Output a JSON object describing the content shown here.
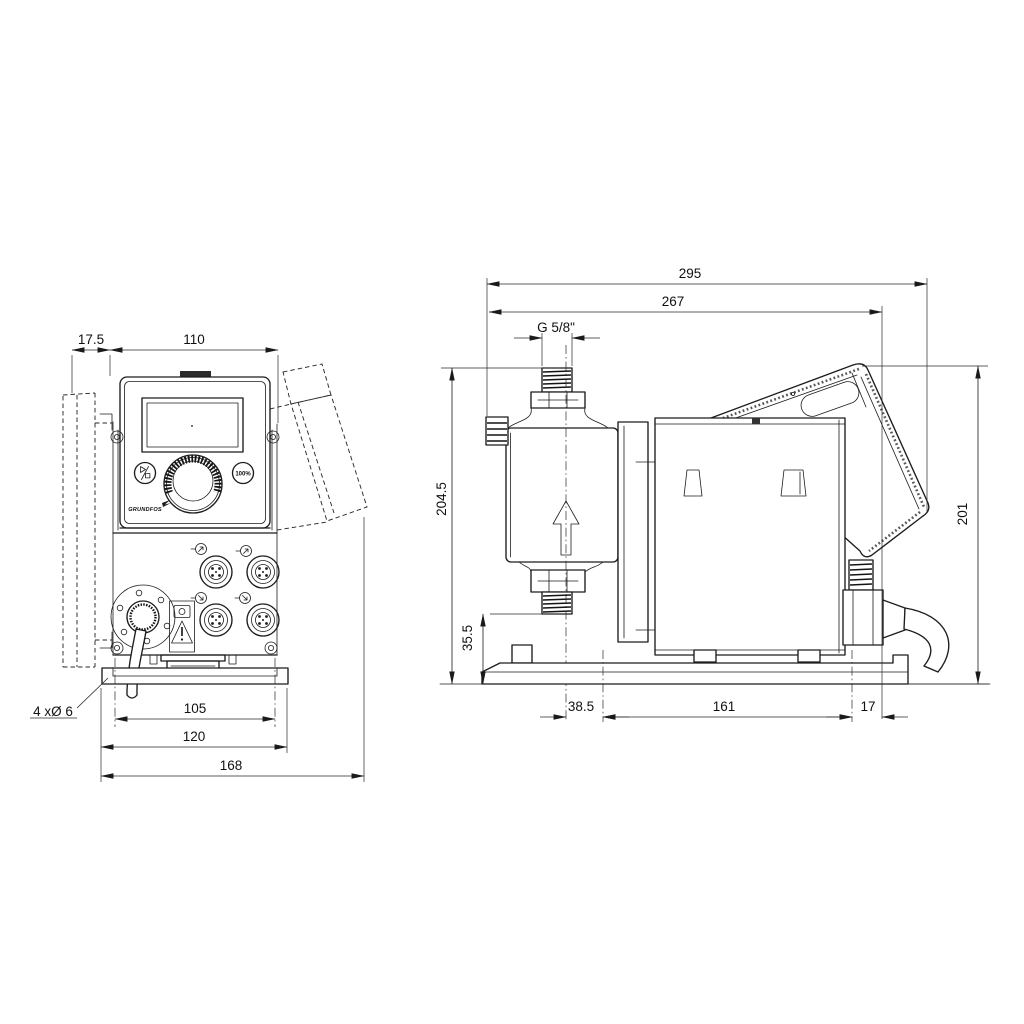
{
  "front_view": {
    "dims": {
      "offset": "17.5",
      "panel_width": "110",
      "hole_spacing": "105",
      "plate_width": "120",
      "overall_width": "168"
    },
    "hole_callout": "4 xØ 6",
    "panel": {
      "logo": "GRUNDFOS",
      "button_100_label": "100%"
    }
  },
  "side_view": {
    "dims": {
      "overall_depth": "295",
      "depth": "267",
      "thread": "G 5/8\"",
      "height_to_inlet": "204.5",
      "overall_height": "201",
      "inlet_height": "35.5",
      "head_offset": "38.5",
      "hole_spacing": "161",
      "rear_offset": "17"
    }
  }
}
